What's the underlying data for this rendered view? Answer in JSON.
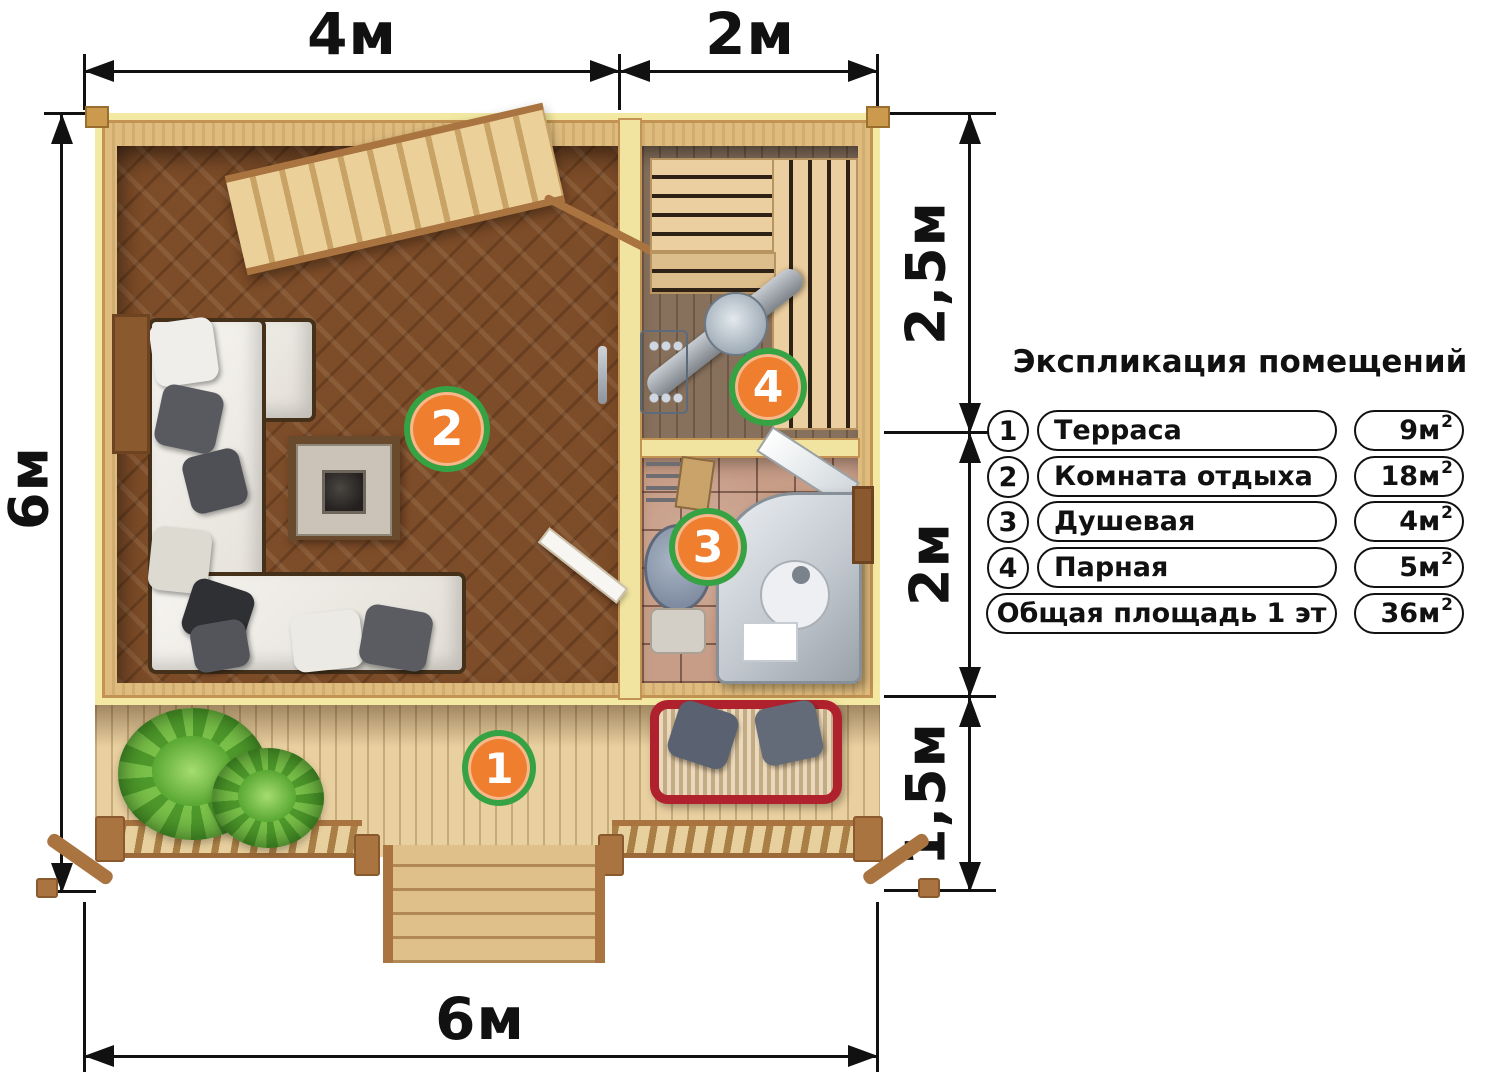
{
  "dimensions": {
    "top_left": "4м",
    "top_right": "2м",
    "left": "6м",
    "right_top": "2,5м",
    "right_middle": "2м",
    "right_bottom": "1,5м",
    "bottom": "6м"
  },
  "badges": [
    {
      "number": "1"
    },
    {
      "number": "2"
    },
    {
      "number": "3"
    },
    {
      "number": "4"
    }
  ],
  "legend": {
    "title": "Экспликация помещений",
    "rows": [
      {
        "num": "1",
        "name": "Терраса",
        "area": "9м",
        "area_sup": "2"
      },
      {
        "num": "2",
        "name": "Комната отдыха",
        "area": "18м",
        "area_sup": "2"
      },
      {
        "num": "3",
        "name": "Душевая",
        "area": "4м",
        "area_sup": "2"
      },
      {
        "num": "4",
        "name": "Парная",
        "area": "5м",
        "area_sup": "2"
      },
      {
        "num": "",
        "name": "Общая площадь 1 эт",
        "area": "36м",
        "area_sup": "2"
      }
    ]
  },
  "colors": {
    "badge_fill": "#ef7f2e",
    "badge_ring": "#35a344",
    "dimension_line": "#111111",
    "wall_wood": "#f3e9a2",
    "lounge_floor": "#7d4c28",
    "deck_wood": "#e9d0a0"
  }
}
